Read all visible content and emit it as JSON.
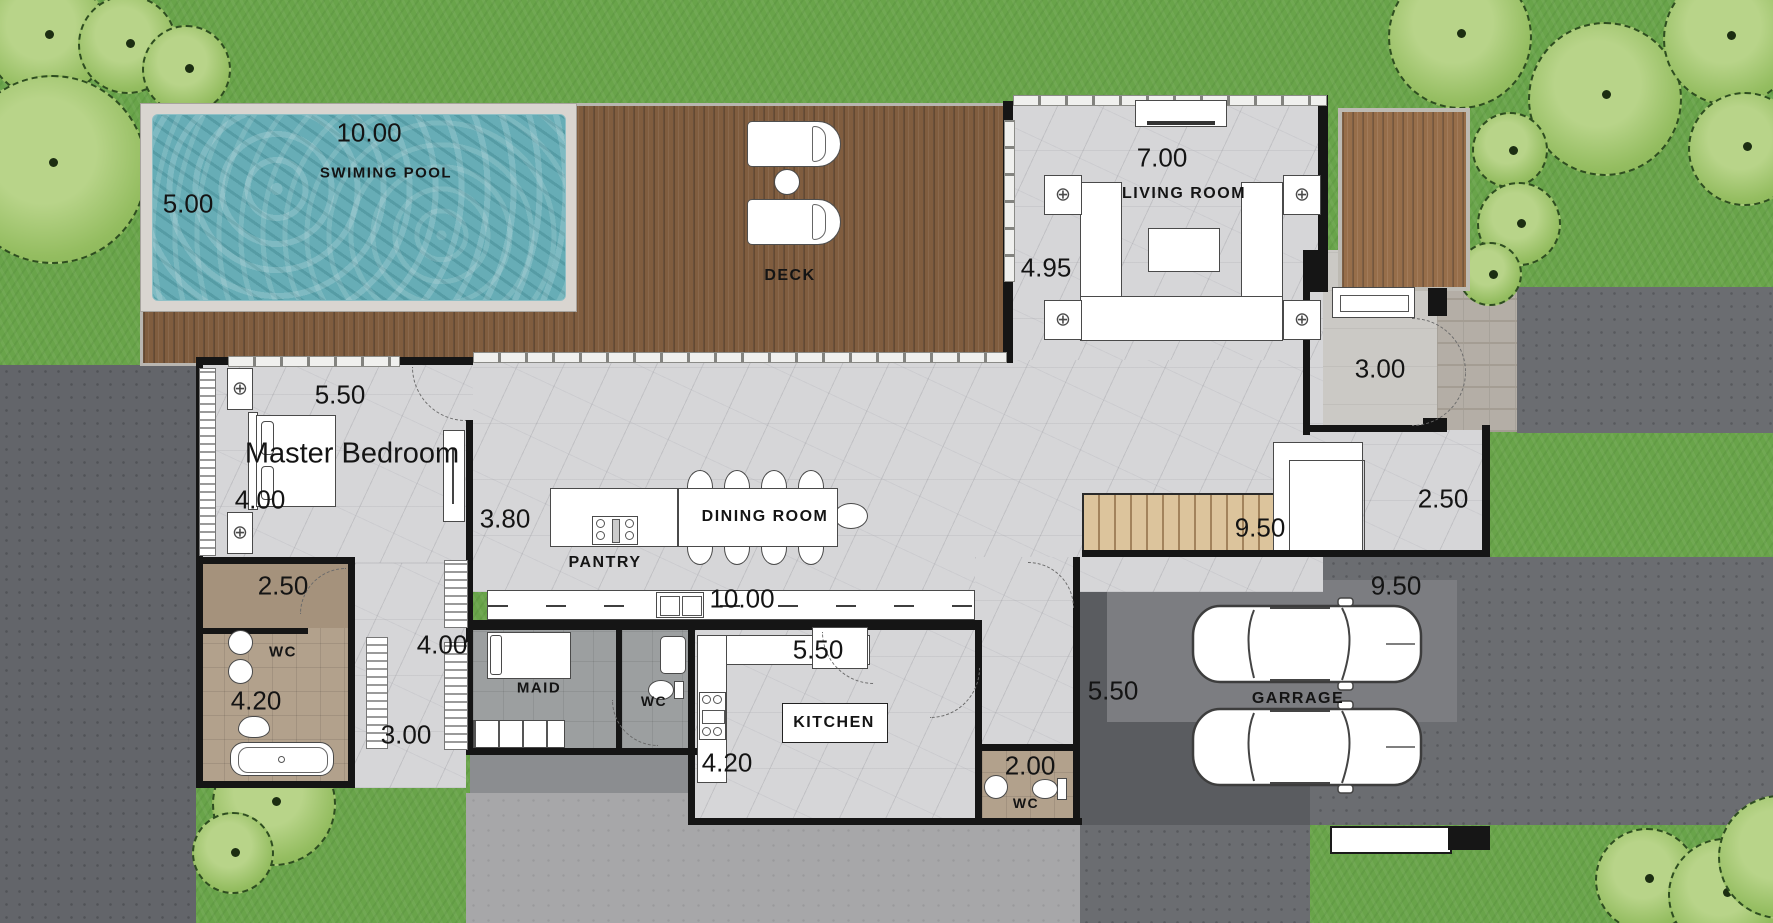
{
  "plan": {
    "pool": {
      "label": "SWIMING POOL",
      "length": "10.00",
      "width": "5.00"
    },
    "deck": {
      "label": "DECK"
    },
    "living_room": {
      "label": "LIVING ROOM",
      "width": "7.00",
      "depth": "4.95"
    },
    "entry": {
      "depth": "3.00"
    },
    "master_bedroom": {
      "label": "Master Bedroom",
      "width": "5.50",
      "depth": "4.00"
    },
    "dining_room": {
      "label": "DINING ROOM",
      "width": "3.80",
      "counter_length": "10.00"
    },
    "pantry": {
      "label": "PANTRY"
    },
    "master_wc": {
      "label": "WC",
      "width": "2.50",
      "depth": "4.20"
    },
    "hallway": {
      "width": "4.00",
      "exit_width": "3.00"
    },
    "maid_room": {
      "label": "MAID"
    },
    "maid_wc": {
      "label": "WC"
    },
    "kitchen": {
      "label": "KITCHEN",
      "width": "5.50",
      "depth": "4.20"
    },
    "guest_wc": {
      "label": "WC",
      "width": "2.00"
    },
    "stairs": {
      "length": "9.50"
    },
    "side_passage": {
      "width": "2.50"
    },
    "garage": {
      "label": "GARRAGE",
      "width": "9.50",
      "depth": "5.50"
    }
  },
  "colors": {
    "grass": "#69a44a",
    "pool_water": "#67adb6",
    "deck_wood": "#805d3f",
    "floor_marble": "#d6d6d8",
    "wall": "#151515",
    "driveway": "#6b6d71",
    "pavement_light": "#a7a7a9",
    "entry_court": "#cbc9c5",
    "stairs_wood": "#dcc49c",
    "wc_tile": "#b2a18c",
    "label_text": "#141414"
  }
}
